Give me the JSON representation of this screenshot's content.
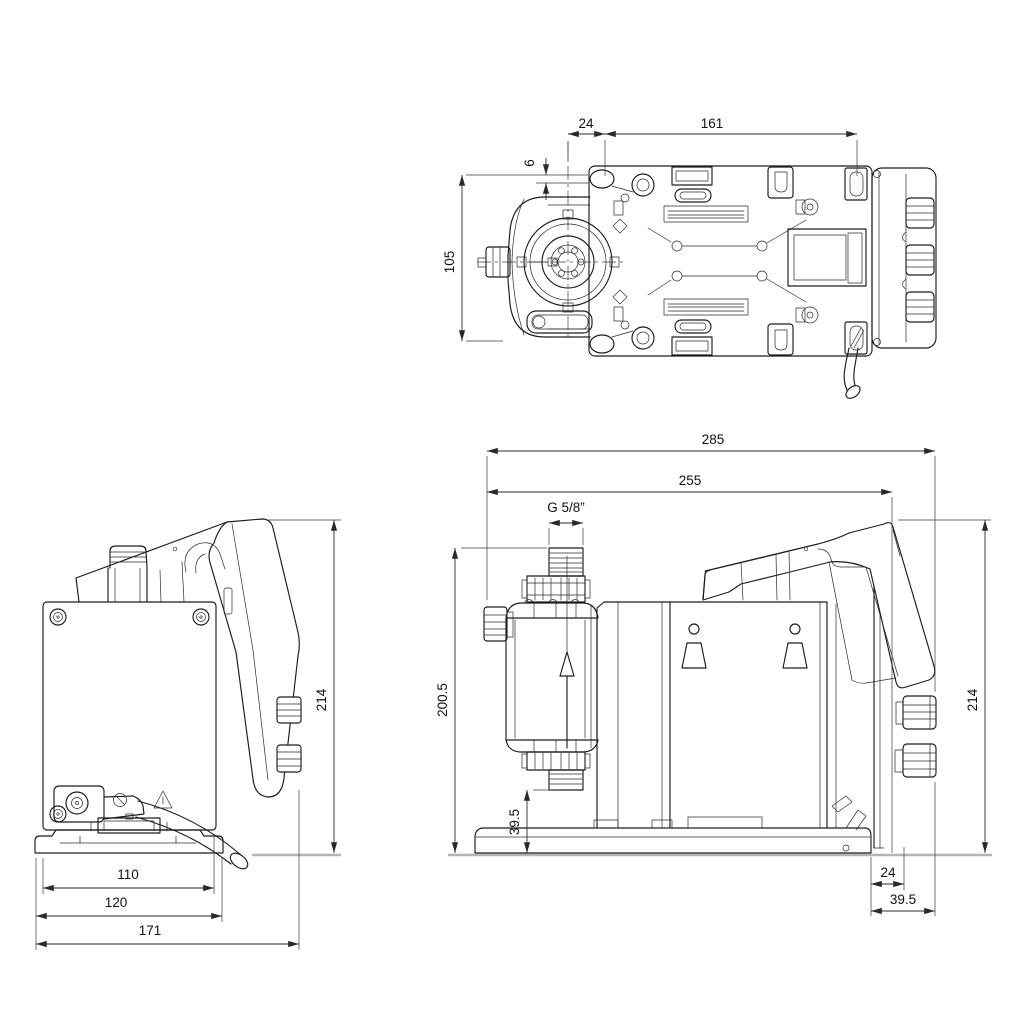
{
  "drawing": {
    "type": "technical-dimension-drawing",
    "views": {
      "top": {
        "dims": {
          "offset_24": "24",
          "slot_span_161": "161",
          "edge_6": "6",
          "depth_105": "105"
        }
      },
      "rear": {
        "dims": {
          "height_214": "214",
          "width_110": "110",
          "width_120": "120",
          "width_171": "171"
        }
      },
      "side": {
        "dims": {
          "length_285": "285",
          "length_255": "255",
          "thread": "G 5/8”",
          "height_200_5": "200.5",
          "clearance_39_5": "39.5",
          "height_214": "214",
          "offset_24": "24",
          "depth_39_5": "39.5"
        }
      }
    },
    "colors": {
      "line": "#1c1c1c",
      "dim": "#2a2a2a",
      "ground": "#b4b4b4",
      "background": "#ffffff"
    }
  }
}
